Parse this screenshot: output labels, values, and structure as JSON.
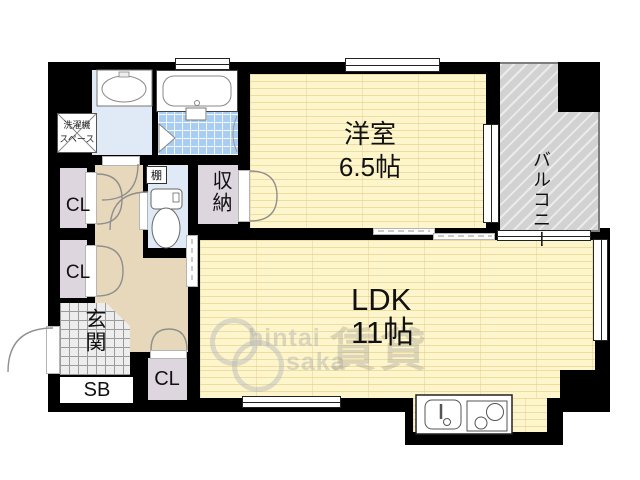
{
  "labels": {
    "western_room": {
      "name": "洋室",
      "area": "6.5帖"
    },
    "ldk": {
      "name": "LDK",
      "area": "11帖"
    },
    "balcony": "バルコニー",
    "entrance": "玄関",
    "storage": "収納",
    "shelf": "棚",
    "closet_upper": "CL",
    "closet_lower": "CL",
    "closet_hall": "CL",
    "shoebox": "SB",
    "washer_line1": "洗濯機",
    "washer_line2": "スペース"
  },
  "watermark": {
    "brand_top": "hintai",
    "brand_bottom": "saka",
    "kanji": "賃貸"
  },
  "colors": {
    "wall": "#000000",
    "floor": "#fdf6cd",
    "floor_stripe": "#e9cb80",
    "closet": "#ddd6df",
    "hallway": "#e7d8bb",
    "wet_area": "#dfeaf6",
    "bath_tile": "#a9cdf0",
    "balcony": "#d2d2d2",
    "entrance_tile": "#ededed"
  }
}
